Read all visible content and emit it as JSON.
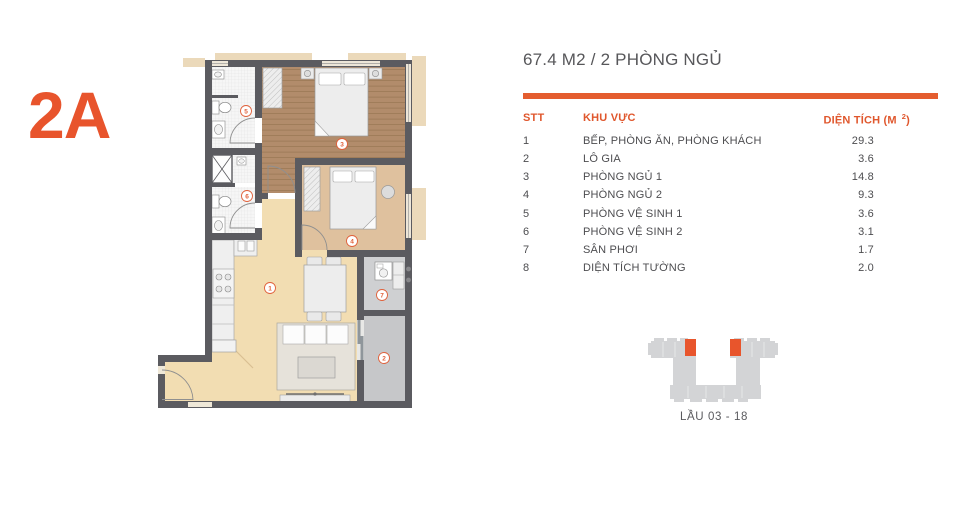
{
  "unit": {
    "code": "2A"
  },
  "header": {
    "title": "67.4 M2 / 2 PHÒNG NGỦ"
  },
  "table": {
    "col_stt": "STT",
    "col_area_name": "KHU VỰC",
    "col_size_prefix": "DIỆN TÍCH (M",
    "col_size_sup": "2",
    "col_size_suffix": ")",
    "rows": [
      {
        "stt": "1",
        "name": "BẾP, PHÒNG ĂN, PHÒNG KHÁCH",
        "value": "29.3"
      },
      {
        "stt": "2",
        "name": "LÔ GIA",
        "value": "3.6"
      },
      {
        "stt": "3",
        "name": "PHÒNG NGỦ 1",
        "value": "14.8"
      },
      {
        "stt": "4",
        "name": "PHÒNG NGỦ 2",
        "value": "9.3"
      },
      {
        "stt": "5",
        "name": "PHÒNG VỆ SINH 1",
        "value": "3.6"
      },
      {
        "stt": "6",
        "name": "PHÒNG VỆ SINH 2",
        "value": "3.1"
      },
      {
        "stt": "7",
        "name": "SÂN PHƠI",
        "value": "1.7"
      },
      {
        "stt": "8",
        "name": "DIỆN TÍCH TƯỜNG",
        "value": "2.0"
      }
    ]
  },
  "floor_plan": {
    "room_labels": [
      "1",
      "2",
      "3",
      "4",
      "5",
      "6",
      "7"
    ]
  },
  "locator": {
    "caption": "LẦU 03 - 18"
  },
  "colors": {
    "accent": "#E45D2F",
    "unit_code": "#E8542C",
    "title_text": "#57575A",
    "body_text": "#4D4D50",
    "wall": "#5B5B60",
    "floor_living": "#F2DDB2",
    "floor_wood": "#B28C6B",
    "floor_bedroom2": "#DFC19E",
    "floor_tile": "#F6F6F6",
    "floor_loggia": "#C6C7C9",
    "exterior_ledge": "#EBD9BA",
    "locator_gray": "#D3D4D6"
  }
}
